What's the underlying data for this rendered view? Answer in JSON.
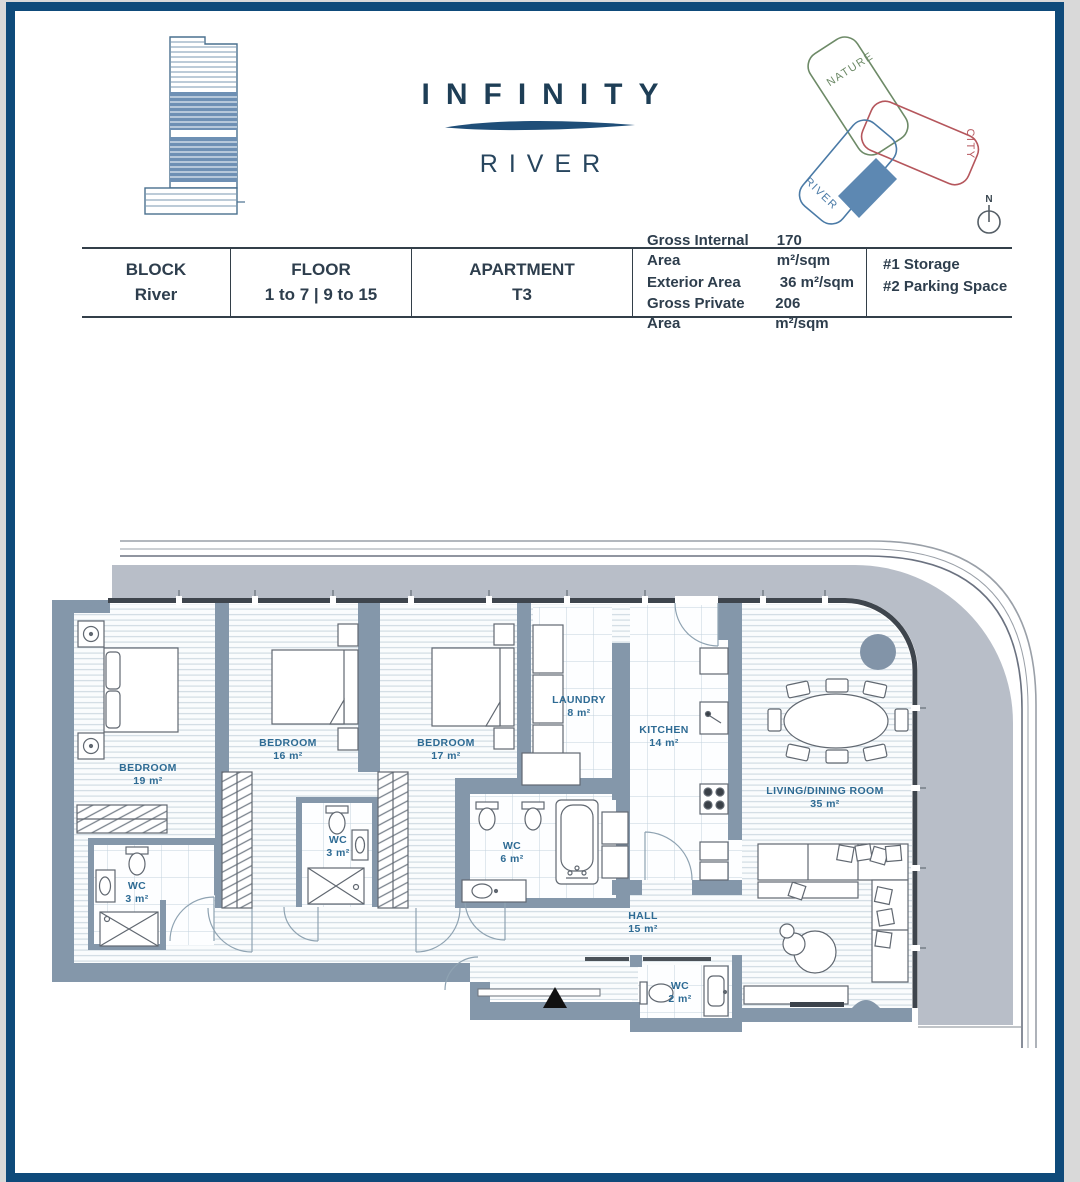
{
  "brand": {
    "name": "INFINITY",
    "subtitle": "RIVER"
  },
  "site_diagram": {
    "nature_label": "NATURE",
    "city_label": "CITY",
    "river_label": "RIVER",
    "compass_label": "N",
    "nature_color": "#6d8a67",
    "city_color": "#b5565c",
    "river_color": "#4a7aa6",
    "highlight_color": "#5d88b2"
  },
  "info_table": {
    "cells": [
      {
        "label": "BLOCK",
        "value": "River"
      },
      {
        "label": "FLOOR",
        "value": "1 to 7 | 9 to 15"
      },
      {
        "label": "APARTMENT",
        "value": "T3"
      }
    ],
    "areas": [
      {
        "label": "Gross Internal Area",
        "value": "170 m²/sqm"
      },
      {
        "label": "Exterior Area",
        "value": "36 m²/sqm"
      },
      {
        "label": "Gross Private Area",
        "value": "206 m²/sqm"
      }
    ],
    "extras": [
      {
        "label": "#1  Storage"
      },
      {
        "label": "#2  Parking Space"
      }
    ]
  },
  "floor_plan": {
    "rooms": [
      {
        "name": "BEDROOM",
        "area": "19 m²"
      },
      {
        "name": "BEDROOM",
        "area": "16 m²"
      },
      {
        "name": "BEDROOM",
        "area": "17 m²"
      },
      {
        "name": "LAUNDRY",
        "area": "8 m²"
      },
      {
        "name": "KITCHEN",
        "area": "14 m²"
      },
      {
        "name": "LIVING/DINING ROOM",
        "area": "35 m²"
      },
      {
        "name": "WC",
        "area": "3 m²"
      },
      {
        "name": "WC",
        "area": "3 m²"
      },
      {
        "name": "WC",
        "area": "6 m²"
      },
      {
        "name": "WC",
        "area": "2 m²"
      },
      {
        "name": "HALL",
        "area": "15 m²"
      }
    ]
  }
}
